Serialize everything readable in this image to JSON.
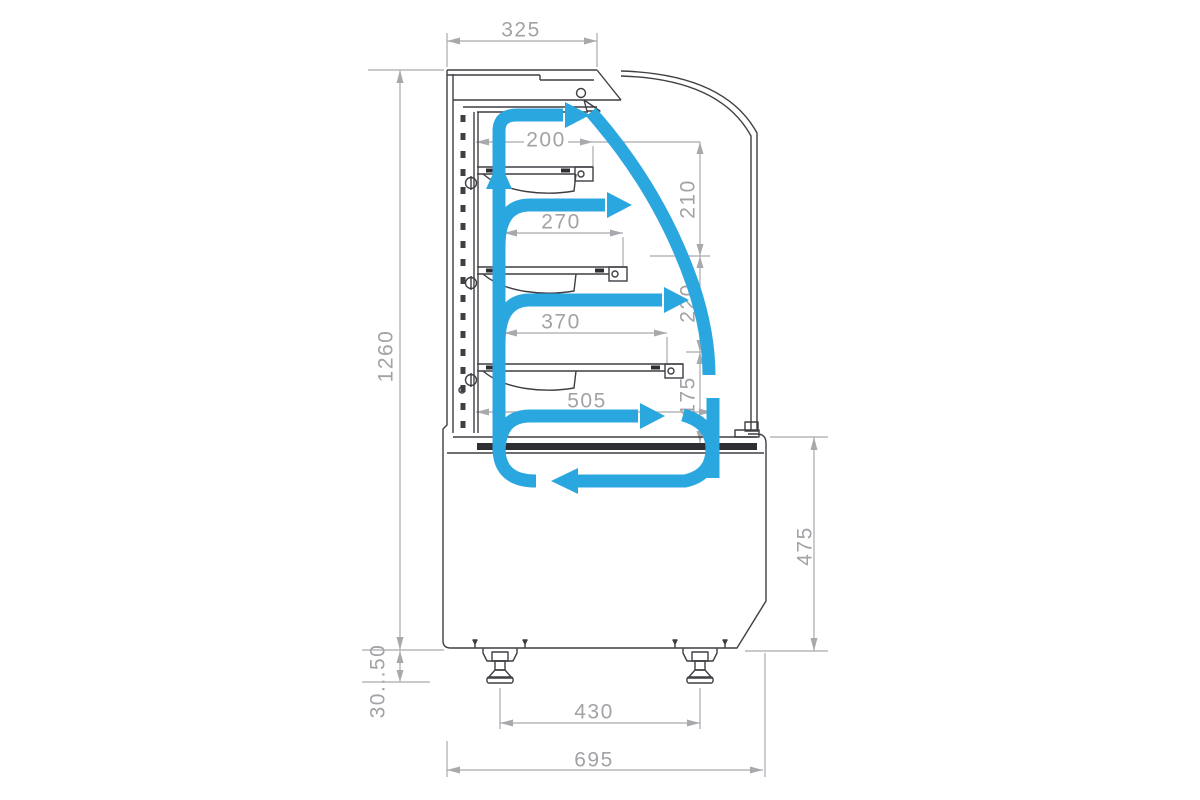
{
  "title": "Refrigerated confectionery display case — side section, airflow and dimensions",
  "colors": {
    "airflow_blue": "#2ba7e0",
    "outline_dark": "#3f3f44",
    "dimension_gray": "#a2a2a7"
  },
  "dimensions": {
    "canopy_depth": "325",
    "shelf1_depth": "200",
    "shelf2_depth": "270",
    "shelf3_depth": "370",
    "deck_depth": "505",
    "overall_height": "1260",
    "gap_top": "210",
    "gap_middle": "220",
    "gap_bottom": "175",
    "base_height": "475",
    "leg_adjustment": "30...50",
    "leg_spacing": "430",
    "overall_depth": "695"
  }
}
